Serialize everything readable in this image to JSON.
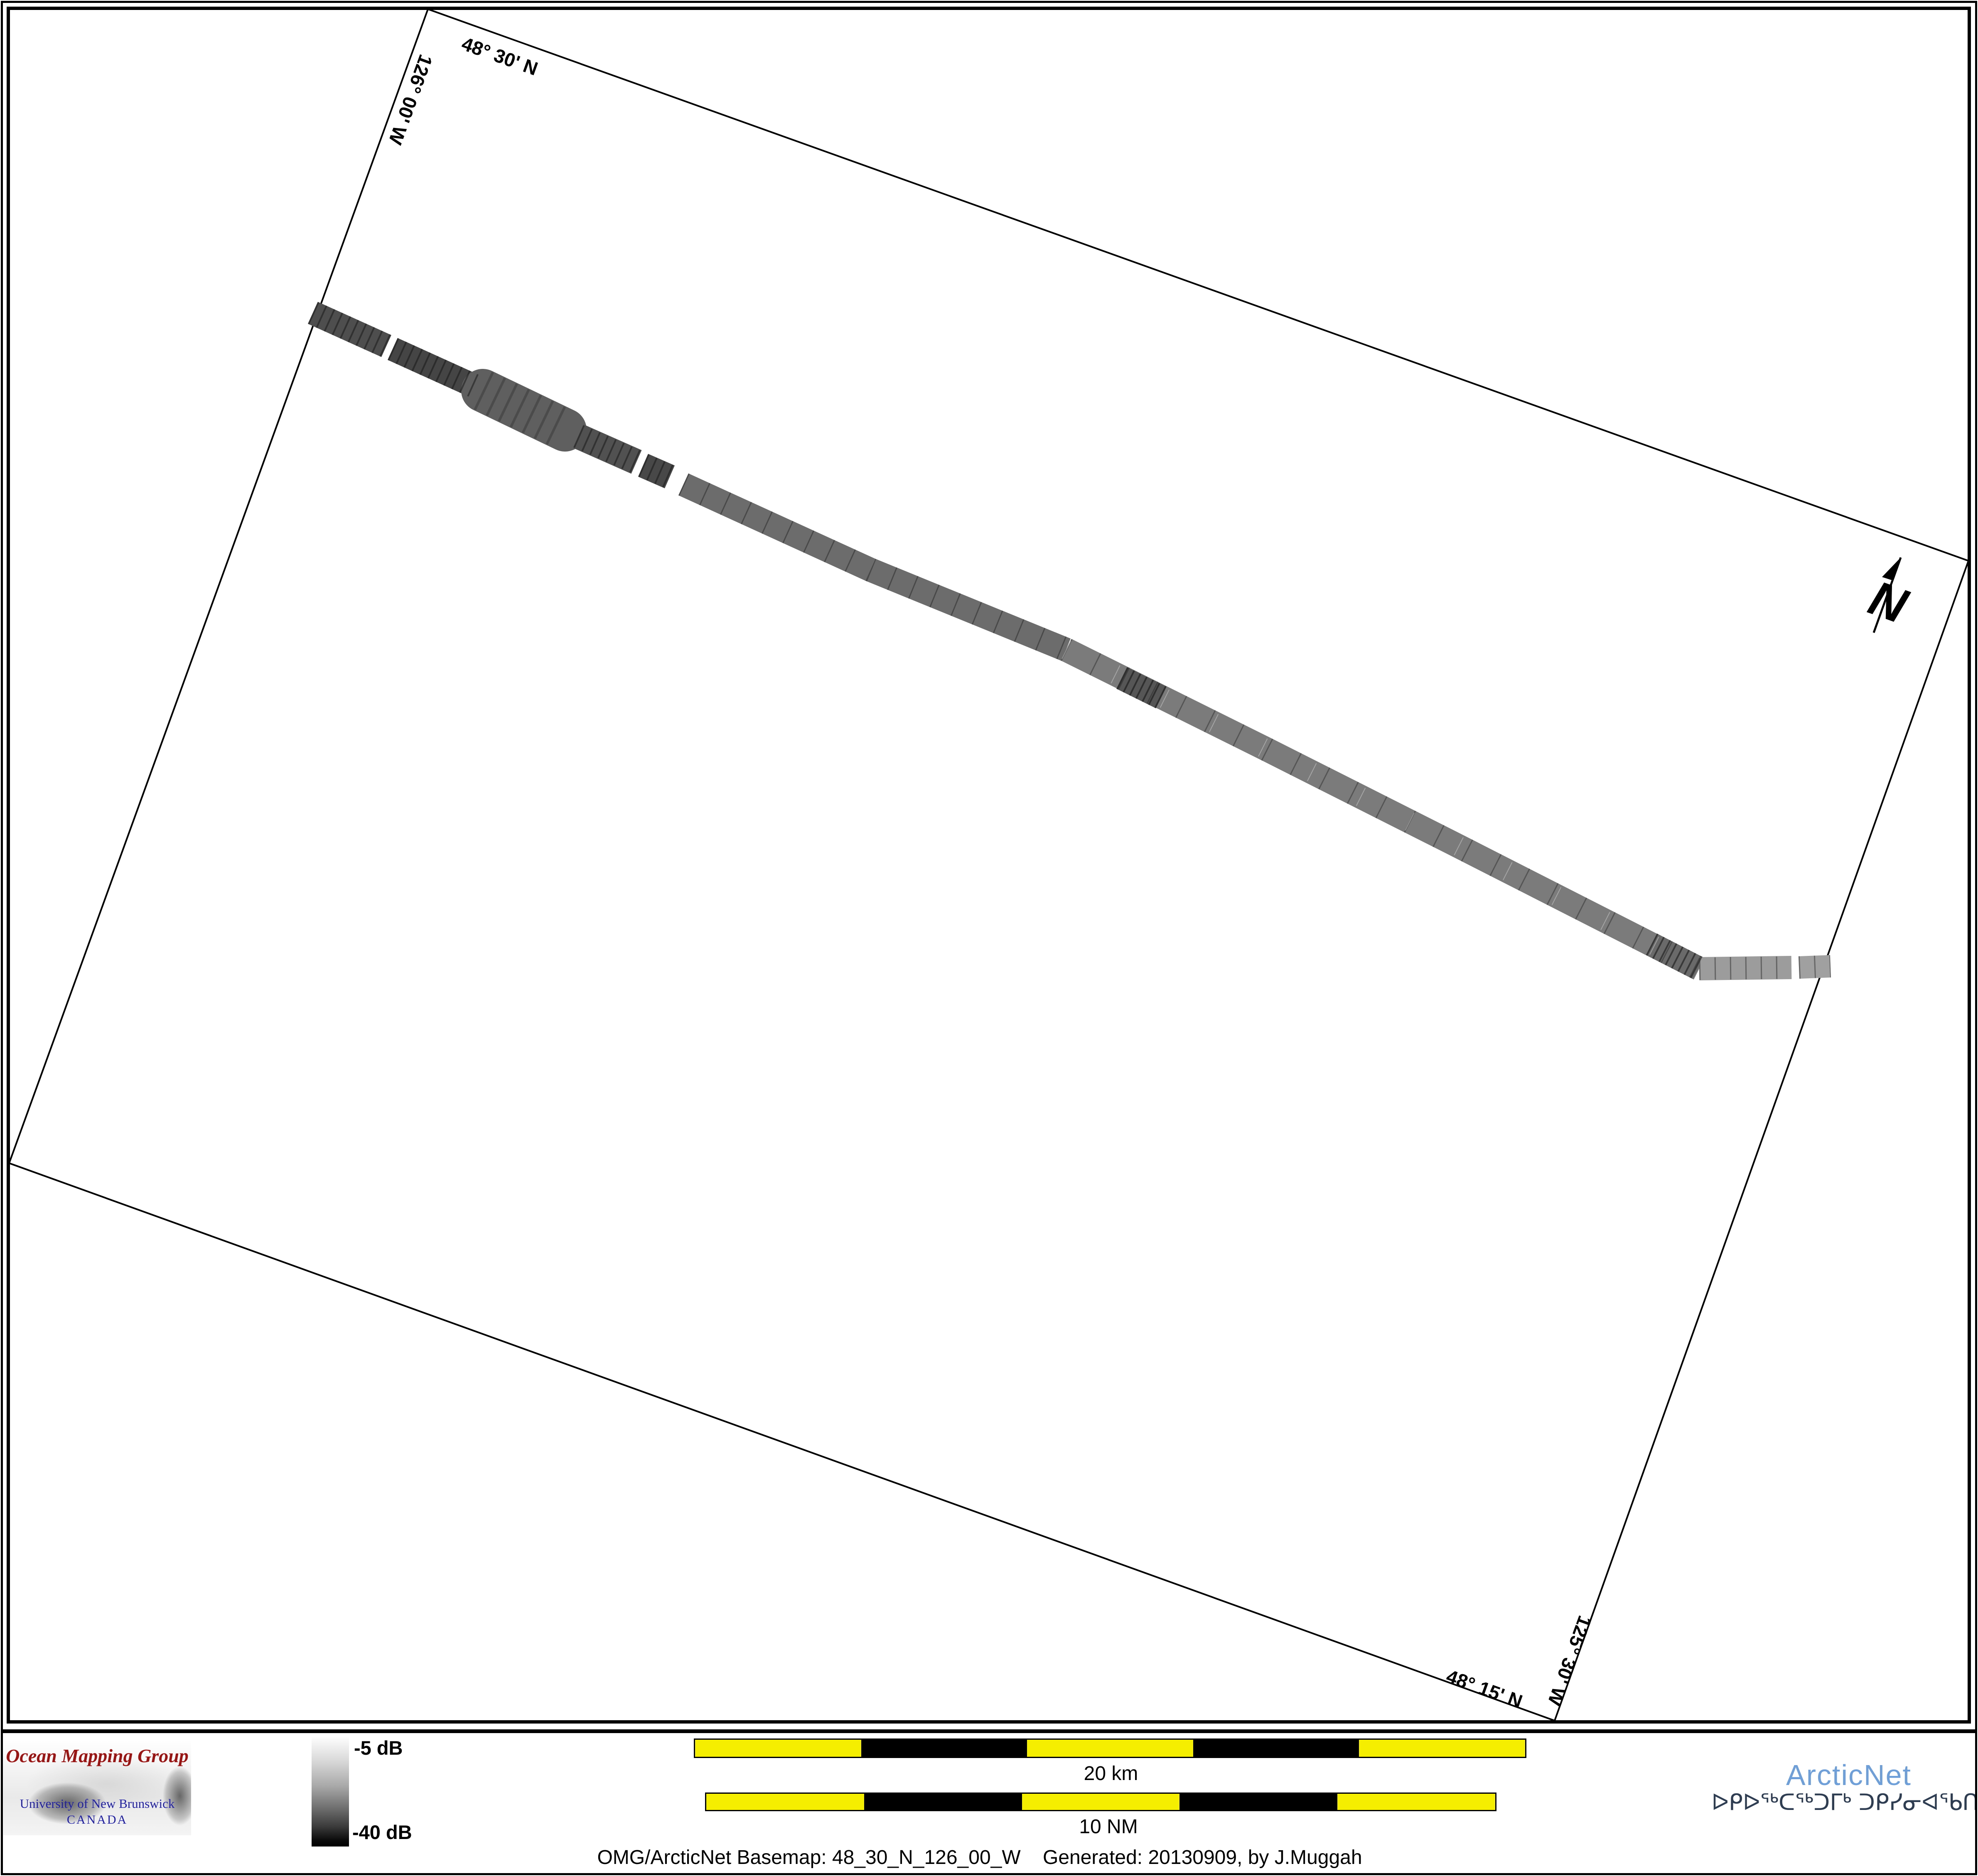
{
  "map": {
    "graticule_labels": {
      "top_lat": "48° 30' N",
      "left_lon": "126° 00' W",
      "right_lon": "125° 30' W",
      "bottom_lat": "48° 15' N"
    },
    "north_label": "N"
  },
  "legend": {
    "top_label": "-5 dB",
    "bottom_label": "-40 dB"
  },
  "scalebars": {
    "km_label": "20 km",
    "nm_label": "10 NM"
  },
  "caption": {
    "text": "OMG/ArcticNet Basemap: 48_30_N_126_00_W    Generated: 20130909, by J.Muggah"
  },
  "omg": {
    "title": "Ocean Mapping Group",
    "line1": "University of New Brunswick",
    "line2": "CANADA"
  },
  "arcticnet": {
    "name": "ArcticNet",
    "syllabics": "ᐅᑭᐅᖅᑕᖅᑐᒥᒃ ᑐᑭᓯᓂᐊᖃᑎᒌᑦ"
  },
  "colors": {
    "scalebar_yellow": "#f6ee00",
    "arcticnet_blue": "#6f9fd8",
    "syllabics_navy": "#2e3d52",
    "omg_red": "#9b1414",
    "unb_blue": "#2121a8"
  }
}
